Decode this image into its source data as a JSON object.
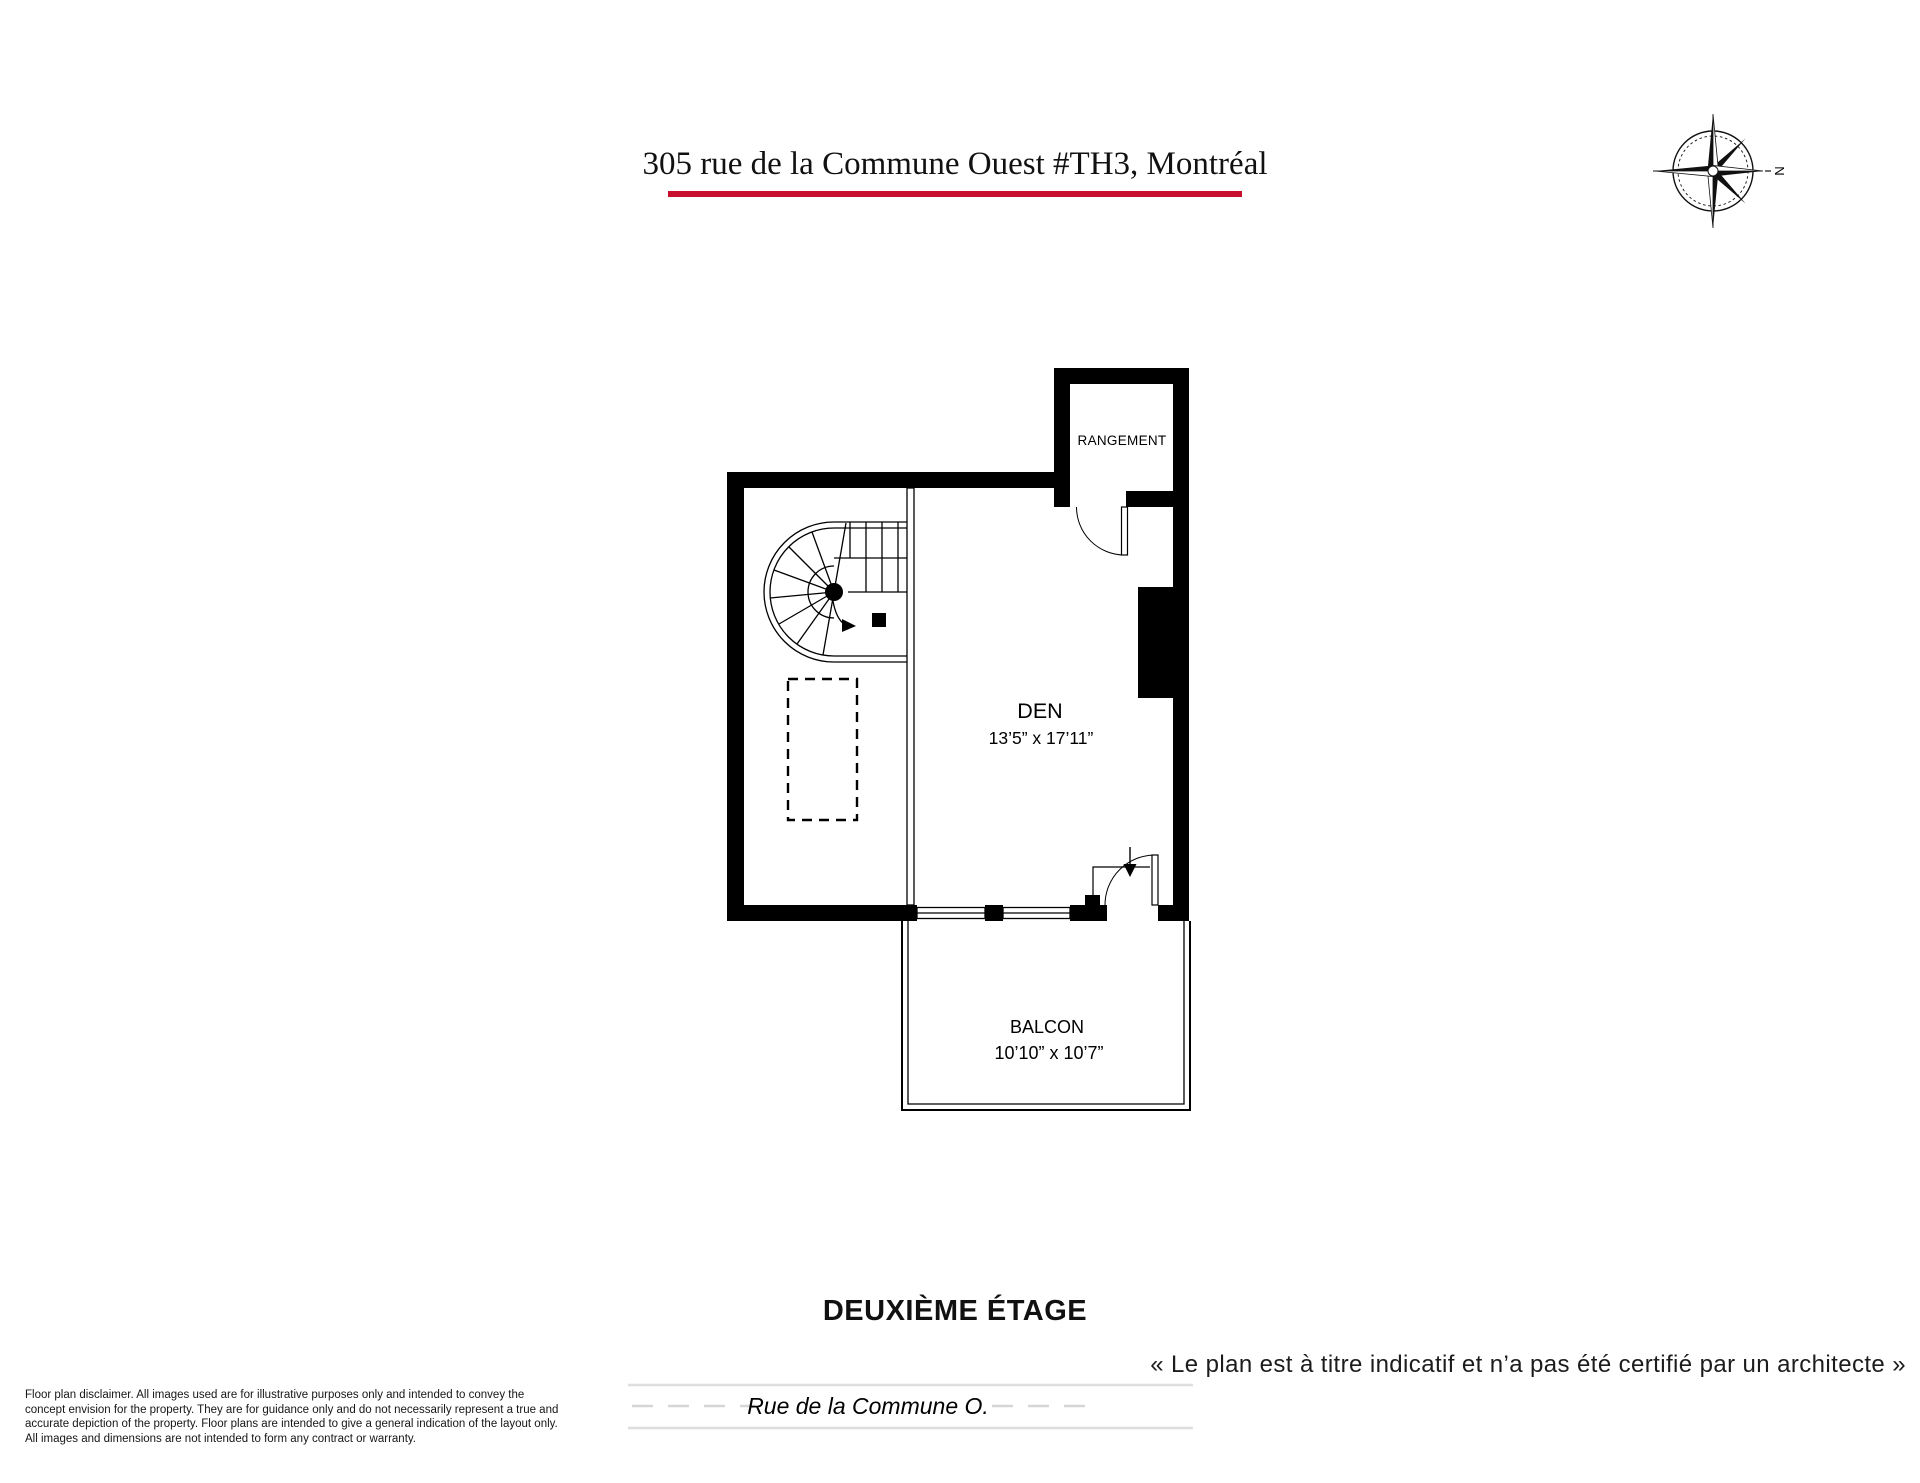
{
  "title": "305 rue de la Commune Ouest #TH3, Montréal",
  "accent_color": "#c8102e",
  "compass": {
    "north_label": "N"
  },
  "plan": {
    "rooms": [
      {
        "name": "RANGEMENT"
      },
      {
        "name": "DEN",
        "dimensions": "13’5” x 17’11”"
      },
      {
        "name": "BALCON",
        "dimensions": "10’10” x 10’7”"
      }
    ]
  },
  "floor_label": "DEUXIÈME ÉTAGE",
  "architect_note": "« Le plan est à titre indicatif et n’a pas été certifié par un architecte »",
  "street_label": "Rue de la Commune O.",
  "disclaimer": {
    "lines": [
      "Floor plan disclaimer. All images used are for illustrative purposes only and intended to convey the",
      "concept envision for the property. They are for guidance only and do not necessarily represent a true and",
      "accurate depiction of the property. Floor plans are intended to give a general indication of the layout only.",
      "All images and dimensions are not intended to form any contract or warranty."
    ]
  }
}
